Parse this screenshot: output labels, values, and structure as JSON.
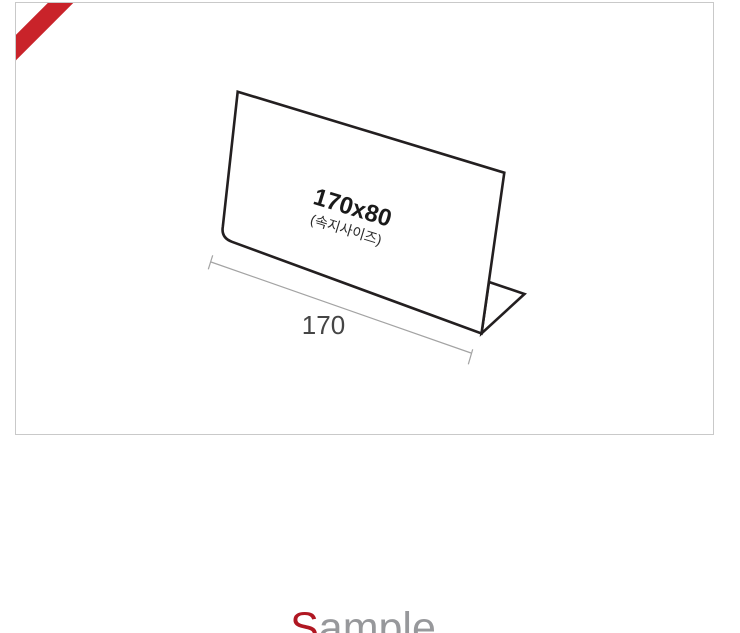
{
  "product_image": {
    "border_color": "#c9c9c9",
    "ribbon_color": "#c9232a",
    "diagram": {
      "type": "line-drawing of L-shaped acrylic sign holder",
      "panel_size_label": "170x80",
      "panel_note_label": "(속지사이즈)",
      "dimension_label": "170",
      "outline_color": "#231f20",
      "dimension_line_color": "#a3a3a3"
    }
  },
  "watermark": {
    "first_letter": "S",
    "rest": "ample",
    "first_letter_color": "#b01722",
    "rest_color": "#97989b"
  }
}
